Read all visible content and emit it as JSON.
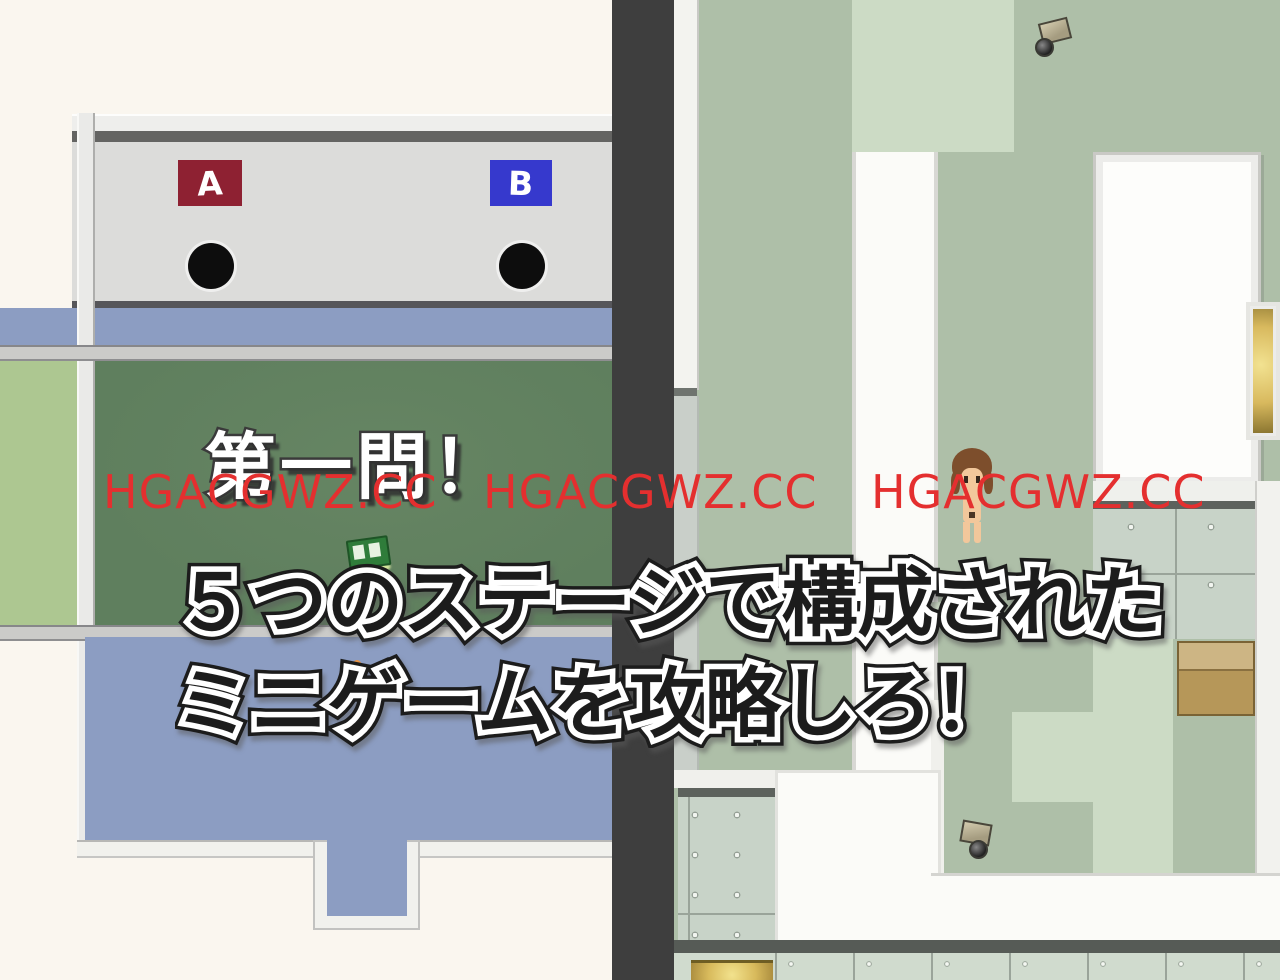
{
  "window": {
    "width": 1280,
    "height": 980,
    "type": "rpg-game-screenshot"
  },
  "watermark": {
    "text": "HGACGWZ.CC",
    "instances": 3,
    "color": "#e42f2f"
  },
  "quiz_room": {
    "question_text": "第一問！",
    "choice_a_label": "A",
    "choice_b_label": "B"
  },
  "caption": {
    "line1": "５つのステージで構成された",
    "line2": "ミニゲームを攻略しろ！"
  },
  "map_view": {
    "objects": [
      "security-camera",
      "security-camera",
      "player-character",
      "cardboard-box",
      "gold-table",
      "supply-box"
    ]
  },
  "colors": {
    "cream": "#faf6ef",
    "wall-gray": "#dcdcda",
    "wall-dark": "#646462",
    "sign-a-red": "#8e2132",
    "sign-b-blue": "#3639cd",
    "floor-blue": "#8c9dc2",
    "rail-gray": "#cbcbc9",
    "band-green": "#adc791",
    "chalkboard-green": "#5f7f5e",
    "divider-dark": "#3e3e3e",
    "sage": "#aebfa8",
    "light-green": "#ccdbc5",
    "white-floor": "#fbfbf8",
    "concrete": "#c8d3c8",
    "concrete-edge": "#5d625d",
    "strip-lower": "#c9cfc9",
    "bottom-strip": "#d0dbce",
    "bottom-line": "#565b56",
    "watermark-red": "#e42f2f",
    "hair-brown": "#7d4e2c",
    "skin": "#f2c79b"
  }
}
